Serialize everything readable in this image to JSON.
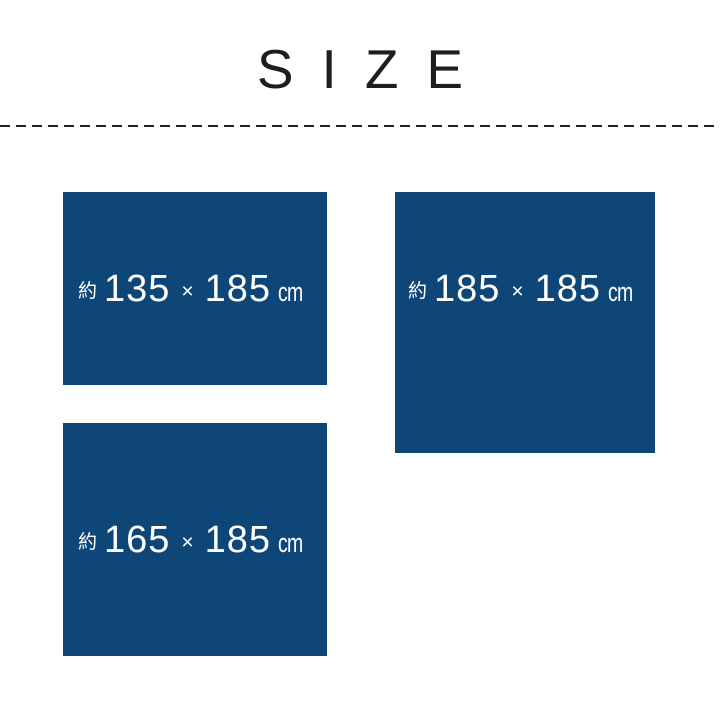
{
  "page": {
    "title": "SIZE"
  },
  "colors": {
    "background": "#ffffff",
    "navy": "#0f4678",
    "ink": "#222222",
    "label_text": "#ffffff"
  },
  "sizes": [
    {
      "id": "135x185",
      "approx": "約",
      "width": "135",
      "times": "×",
      "depth": "185",
      "unit": "cm"
    },
    {
      "id": "185x185",
      "approx": "約",
      "width": "185",
      "times": "×",
      "depth": "185",
      "unit": "cm"
    },
    {
      "id": "165x185",
      "approx": "約",
      "width": "165",
      "times": "×",
      "depth": "185",
      "unit": "cm"
    }
  ]
}
